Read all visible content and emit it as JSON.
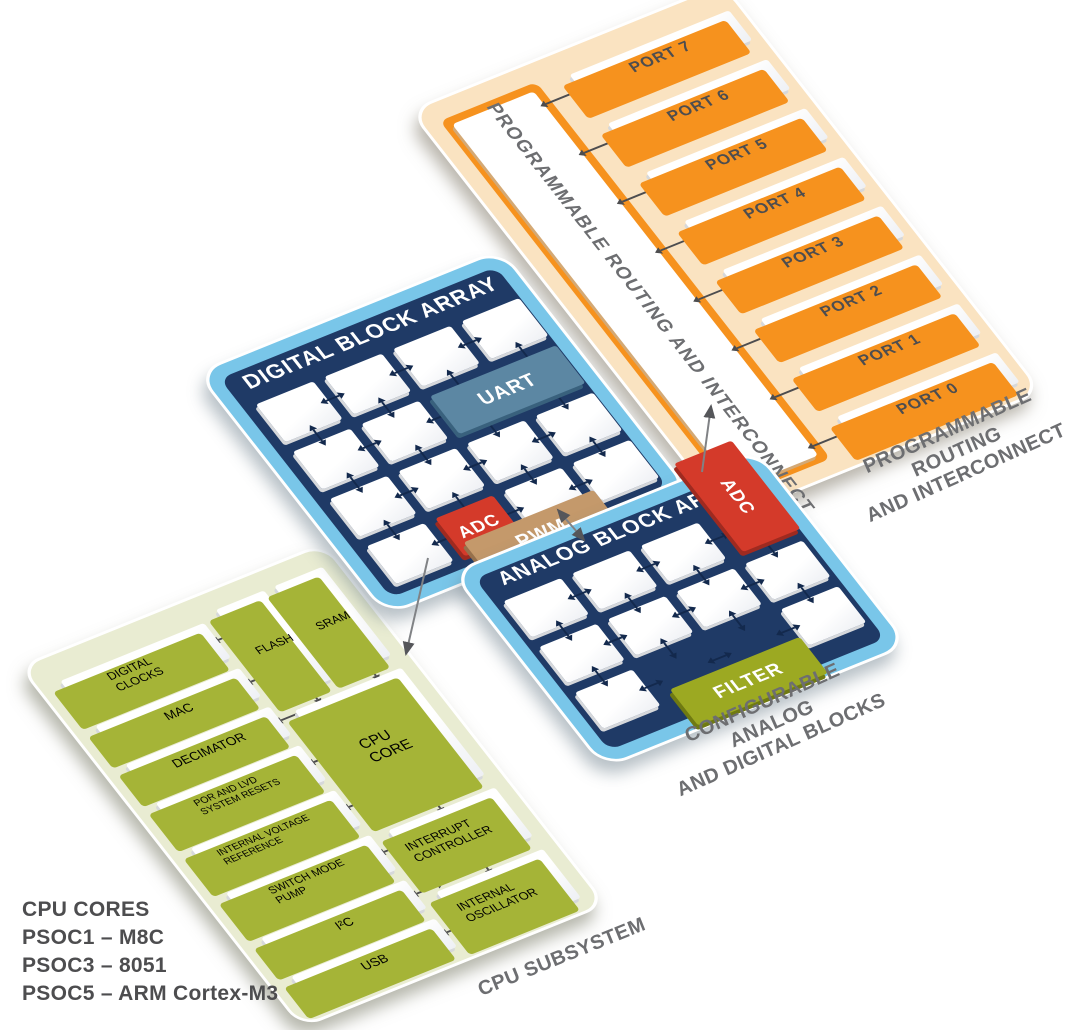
{
  "panels": {
    "routing": {
      "title": "PROGRAMMABLE ROUTING AND INTERCONNECT",
      "caption_line1": "PROGRAMMABLE ROUTING",
      "caption_line2": "AND INTERCONNECT",
      "ports": [
        "PORT 7",
        "PORT 6",
        "PORT 5",
        "PORT 4",
        "PORT 3",
        "PORT 2",
        "PORT 1",
        "PORT 0"
      ]
    },
    "digital": {
      "title": "DIGITAL BLOCK ARRAY",
      "blocks": {
        "uart": "UART",
        "adc": "ADC",
        "pwm": "PWM"
      }
    },
    "analog": {
      "title": "ANALOG BLOCK ARRAY",
      "blocks": {
        "adc": "ADC",
        "filter": "FILTER"
      },
      "caption_line1": "CONFIGURABLE ANALOG",
      "caption_line2": "AND DIGITAL BLOCKS"
    },
    "cpu": {
      "caption": "CPU SUBSYSTEM",
      "left_blocks": [
        "DIGITAL CLOCKS",
        "MAC",
        "DECIMATOR",
        "POR AND LVD SYSTEM RESETS",
        "INTERNAL VOLTAGE REFERENCE",
        "SWITCH MODE PUMP",
        "I²C",
        "USB"
      ],
      "memory_blocks": [
        "FLASH",
        "SRAM"
      ],
      "right_blocks": [
        "CPU CORE",
        "INTERRUPT CONTROLLER",
        "INTERNAL OSCILLATOR"
      ]
    }
  },
  "legend": {
    "lines": [
      "CPU CORES",
      "PSOC1 – M8C",
      "PSOC3 – 8051",
      "PSOC5 – ARM Cortex-M3"
    ]
  },
  "colors": {
    "orange": "#F6921E",
    "peach": "#FAE3C1",
    "light_blue": "#79C6E9",
    "navy": "#1F3A66",
    "uart_blue": "#5C87A3",
    "adc_red": "#D43A2A",
    "pwm_tan": "#C4996B",
    "filter_olive": "#9CA922",
    "cpu_pale": "#E9ECD2",
    "cpu_olive": "#A5B437",
    "label_gray": "#4D4D4F",
    "caption_gray": "#6D6E71",
    "connector_gray": "#808285"
  }
}
